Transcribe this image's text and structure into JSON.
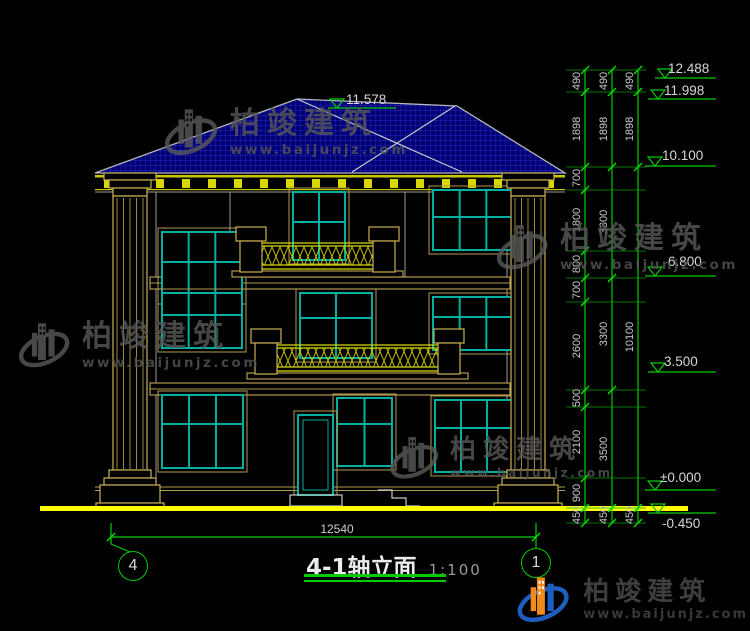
{
  "drawing": {
    "title": "4-1轴立面",
    "scale": "1:100",
    "axis_left": "4",
    "axis_right": "1",
    "width_dim": "12540",
    "ridge_elevation": "11.578"
  },
  "elevation_markers": [
    "12.488",
    "11.998",
    "10.100",
    "6.800",
    "3.500",
    "±0.000",
    "-0.450"
  ],
  "dims": {
    "inner": [
      "490",
      "1898",
      "700",
      "1800",
      "800",
      "700",
      "2600",
      "500",
      "2100",
      "900",
      "450"
    ],
    "middle": [
      "490",
      "1898",
      "3300",
      "3300",
      "3500",
      "450"
    ],
    "outer": [
      "490",
      "1898",
      "10100",
      "450"
    ]
  },
  "watermark": {
    "brand": "柏竣建筑",
    "url": "www.baijunjz.com"
  },
  "colors": {
    "dim_green": "#00cc00",
    "window_teal": "#00afa0",
    "ground_yellow": "#ffff00",
    "trim_tan": "#b09a50",
    "roof_blue": "#000072",
    "logo_orange": "#f08a1d",
    "logo_blue": "#1d5fc0"
  }
}
